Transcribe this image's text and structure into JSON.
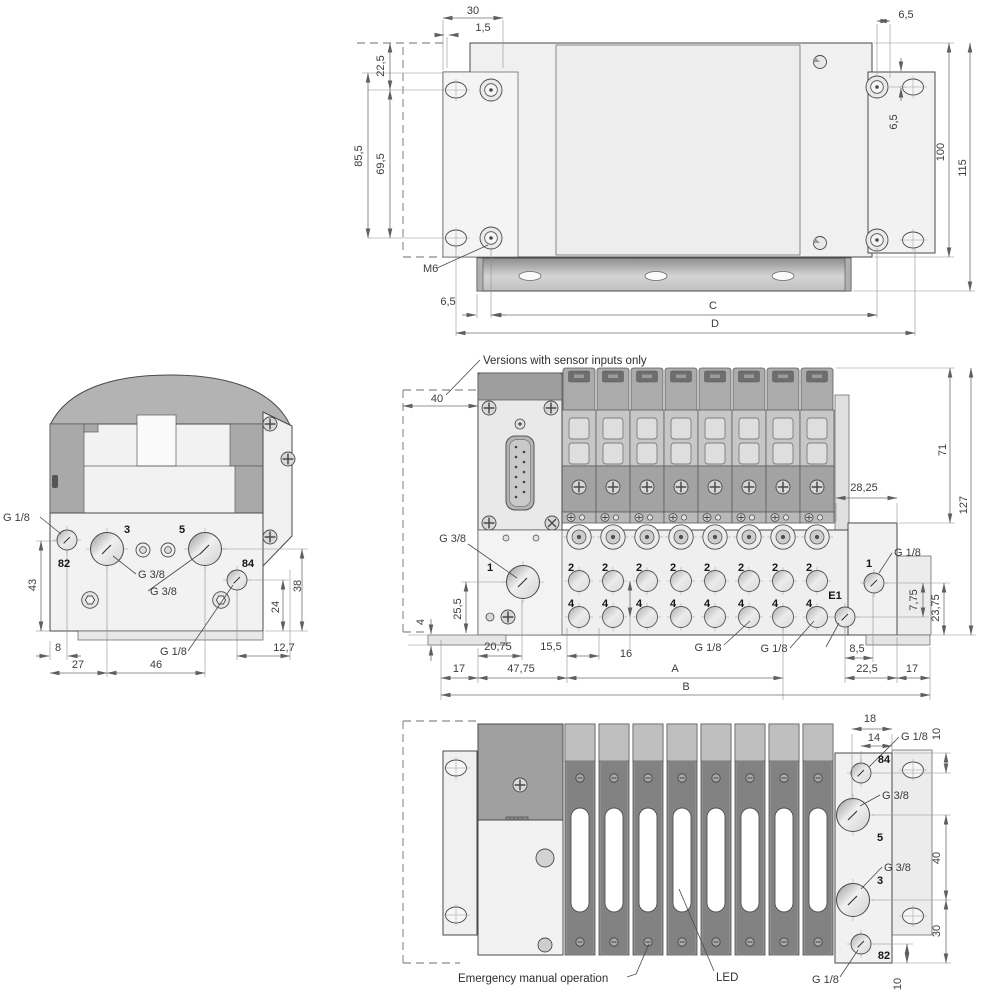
{
  "drawing": {
    "type": "valve terminal dimensional drawing",
    "views": [
      "top",
      "side",
      "front",
      "bottom"
    ]
  },
  "palette": {
    "line": "#4a4a4a",
    "dim_line": "#6f6f6f",
    "body_light": "#f0f0f0",
    "body_mid": "#c7c7c7",
    "body_dark": "#8f8f8f"
  },
  "top_view": {
    "dims": {
      "w30": "30",
      "w1_5": "1,5",
      "h22_5": "22,5",
      "h85_5": "85,5",
      "h69_5": "69,5",
      "w6_5_top": "6,5",
      "h6_5": "6,5",
      "h100": "100",
      "h115": "115",
      "w6_5_bottom": "6,5",
      "c": "C",
      "d": "D"
    },
    "labels": {
      "m6": "M6"
    }
  },
  "side_view": {
    "port_labels": {
      "p82": "82",
      "p3": "3",
      "p5": "5",
      "p84": "84"
    },
    "callouts": {
      "g18_top": "G 1/8",
      "g38_p3": "G 3/8",
      "g38_p5": "G 3/8",
      "g18_p84": "G 1/8"
    },
    "dims": {
      "h43": "43",
      "w8": "8",
      "w27": "27",
      "w46": "46",
      "h24": "24",
      "h38": "38",
      "w12_7": "12,7"
    }
  },
  "front_view": {
    "note": "Versions with sensor inputs only",
    "port_labels": {
      "p1_left": "1",
      "p2": "2",
      "p4": "4",
      "e1": "E1",
      "p1_right": "1"
    },
    "callouts": {
      "g38": "G 3/8",
      "g18_station_a": "G 1/8",
      "g18_station_b": "G 1/8",
      "g18_right": "G 1/8"
    },
    "dims": {
      "w40": "40",
      "h25_5": "25,5",
      "h4": "4",
      "w20_75": "20,75",
      "w15_5": "15,5",
      "w16": "16",
      "w17_left": "17",
      "w47_75": "47,75",
      "a": "A",
      "b": "B",
      "w8_5": "8,5",
      "w22_5": "22,5",
      "w17_right": "17",
      "w28_25": "28,25",
      "h71": "71",
      "h127": "127",
      "h7_75": "7,75",
      "h23_75": "23,75"
    }
  },
  "bottom_view": {
    "port_labels": {
      "p84": "84",
      "p5": "5",
      "p3": "3",
      "p82": "82"
    },
    "callouts": {
      "g18_top": "G 1/8",
      "g38_p5": "G 3/8",
      "g38_p3": "G 3/8",
      "g18_bottom": "G 1/8",
      "emergency": "Emergency manual operation",
      "led": "LED"
    },
    "dims": {
      "w18": "18",
      "w14": "14",
      "h10_top": "10",
      "h40": "40",
      "h30": "30",
      "h10_bottom": "10"
    }
  }
}
